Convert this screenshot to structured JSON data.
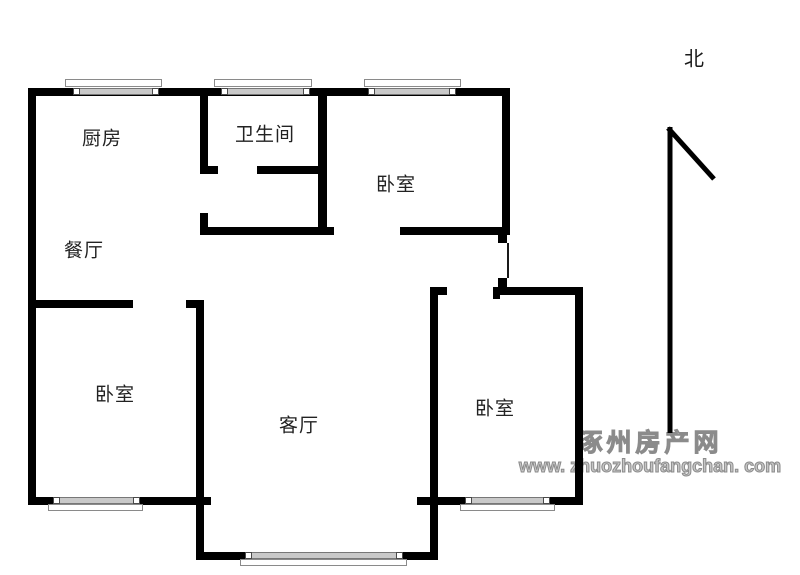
{
  "title": "apartment-floor-plan",
  "colors": {
    "background": "#ffffff",
    "wall": "#000000",
    "label_text": "#222222",
    "window_glass": "#c9c9c9",
    "window_border": "#8a8a8a",
    "watermark_gray": "#8b8b8b"
  },
  "compass": {
    "label": "北"
  },
  "rooms": {
    "kitchen": {
      "label": "厨房"
    },
    "bathroom": {
      "label": "卫生间"
    },
    "bedroom_ne": {
      "label": "卧室"
    },
    "dining": {
      "label": "餐厅"
    },
    "bedroom_sw": {
      "label": "卧室"
    },
    "living": {
      "label": "客厅"
    },
    "bedroom_se": {
      "label": "卧室"
    }
  },
  "watermark": {
    "site_name": "涿州房产网",
    "url": "www. zhuozhoufangchan. com"
  }
}
